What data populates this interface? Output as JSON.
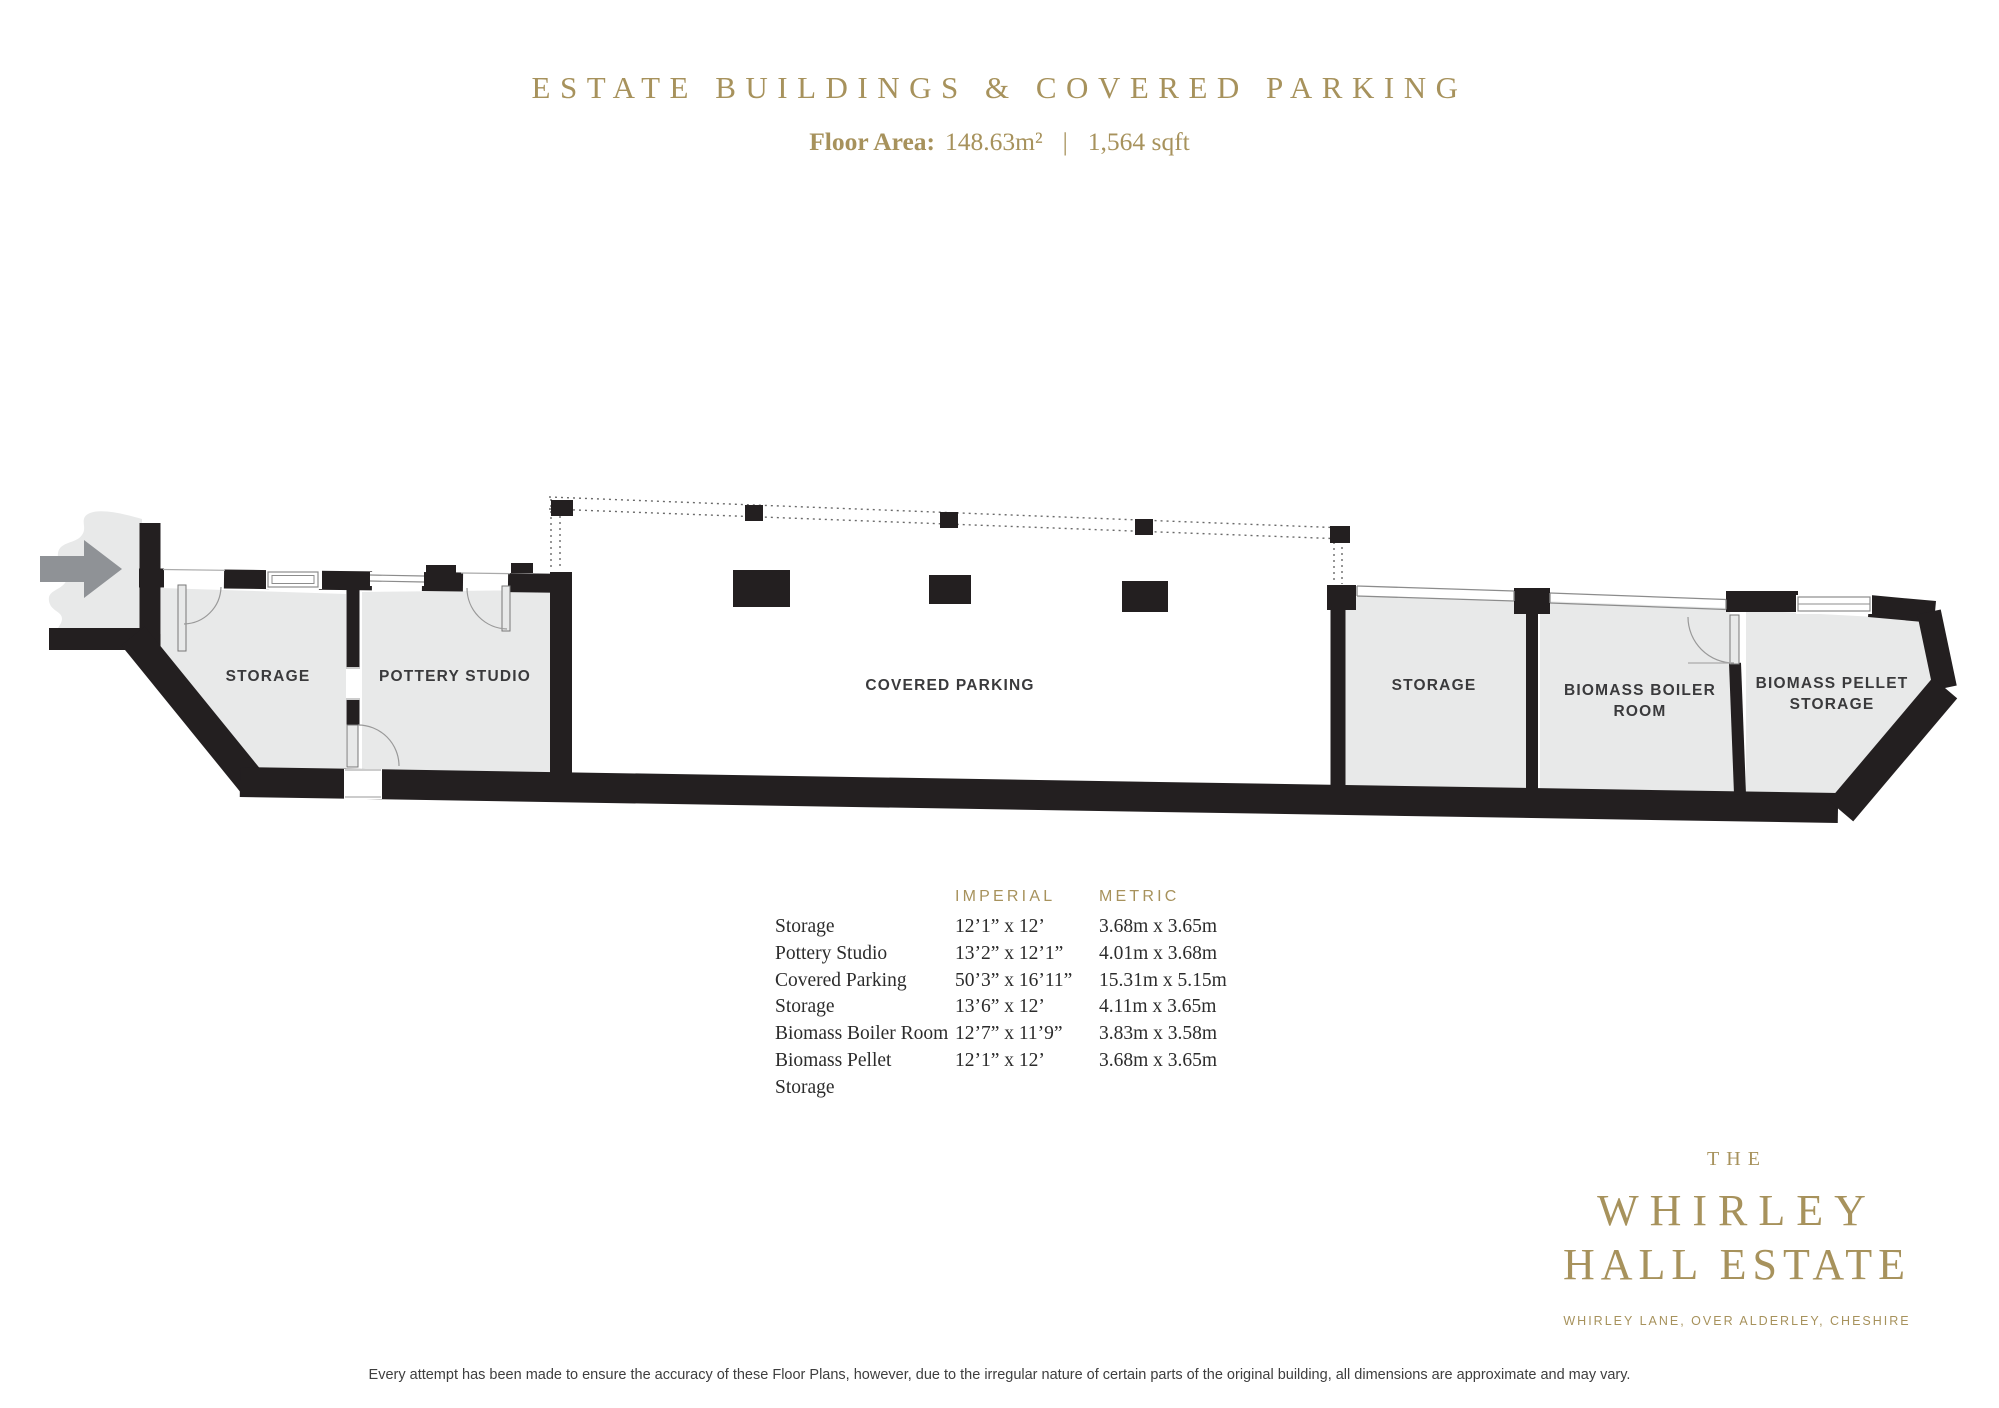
{
  "header": {
    "title": "ESTATE BUILDINGS & COVERED PARKING",
    "floor_area_label": "Floor Area:",
    "floor_area_metric": "148.63m²",
    "separator": "|",
    "floor_area_imperial": "1,564 sqft"
  },
  "plan": {
    "rooms": {
      "storage_left": "STORAGE",
      "pottery_studio": "POTTERY STUDIO",
      "covered_parking": "COVERED PARKING",
      "storage_right": "STORAGE",
      "biomass_boiler_line1": "BIOMASS BOILER",
      "biomass_boiler_line2": "ROOM",
      "biomass_pellet_line1": "BIOMASS PELLET",
      "biomass_pellet_line2": "STORAGE"
    }
  },
  "table": {
    "headers": {
      "imperial": "IMPERIAL",
      "metric": "METRIC"
    },
    "rows": [
      {
        "name": "Storage",
        "imperial": "12’1” x 12’",
        "metric": "3.68m x 3.65m"
      },
      {
        "name": "Pottery Studio",
        "imperial": "13’2” x 12’1”",
        "metric": "4.01m x 3.68m"
      },
      {
        "name": "Covered Parking",
        "imperial": "50’3” x 16’11”",
        "metric": "15.31m x 5.15m"
      },
      {
        "name": "Storage",
        "imperial": "13’6” x 12’",
        "metric": "4.11m x 3.65m"
      },
      {
        "name": "Biomass Boiler Room",
        "imperial": "12’7” x 11’9”",
        "metric": "3.83m x 3.58m"
      },
      {
        "name": "Biomass Pellet Storage",
        "imperial": "12’1” x 12’",
        "metric": "3.68m x 3.65m"
      }
    ]
  },
  "branding": {
    "prefix": "THE",
    "name_line1": "WHIRLEY",
    "name_line2": "HALL ESTATE",
    "address": "WHIRLEY LANE, OVER ALDERLEY, CHESHIRE"
  },
  "footer": {
    "disclaimer": "Every attempt has been made to ensure the accuracy of these Floor Plans, however, due to the irregular nature of certain parts of the original building, all dimensions are approximate and may vary."
  },
  "colors": {
    "gold": "#a7925c",
    "wall": "#231f20",
    "floor": "#e8e9e9",
    "arrow": "#8f9296",
    "label": "#3a3a3c"
  }
}
